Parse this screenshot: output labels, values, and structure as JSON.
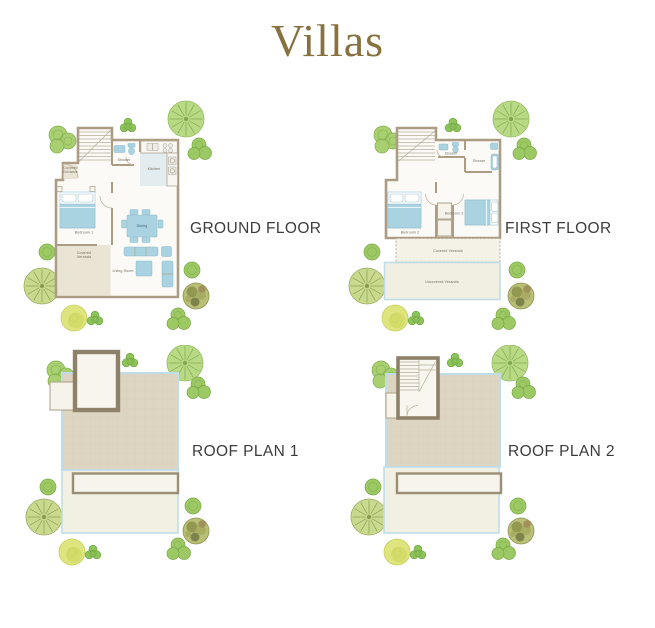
{
  "title": "Villas",
  "colors": {
    "title_gold": "#87713f",
    "caption_text": "#3c3c3c",
    "wall_taupe": "#ab9c83",
    "furniture_blue": "#a9d3e0",
    "roof_beige": "#ddd5c1",
    "veranda_beige": "#eae4d4",
    "plan_floor": "#fbfaf6",
    "pool_edge_blue": "#bfdde9"
  },
  "plans": [
    {
      "id": "ground-floor",
      "caption": "GROUND FLOOR",
      "rooms": {
        "covered_entrance": "Covered Entrance",
        "shower": "Shower",
        "kitchen": "Kitchen",
        "bedroom_1": "Bedroom 1",
        "covered_veranda": "Covered Veranda",
        "dining": "Dining",
        "living_room": "Living Room"
      }
    },
    {
      "id": "first-floor",
      "caption": "FIRST FLOOR",
      "rooms": {
        "shower_1": "Shower",
        "shower_2": "Shower",
        "bedroom_2": "Bedroom 2",
        "bedroom_3": "Bedroom 3",
        "covered_veranda": "Covered Veranda",
        "uncovered_veranda": "Uncovered Veranda"
      }
    },
    {
      "id": "roof-plan-1",
      "caption": "ROOF PLAN 1"
    },
    {
      "id": "roof-plan-2",
      "caption": "ROOF PLAN 2"
    }
  ]
}
